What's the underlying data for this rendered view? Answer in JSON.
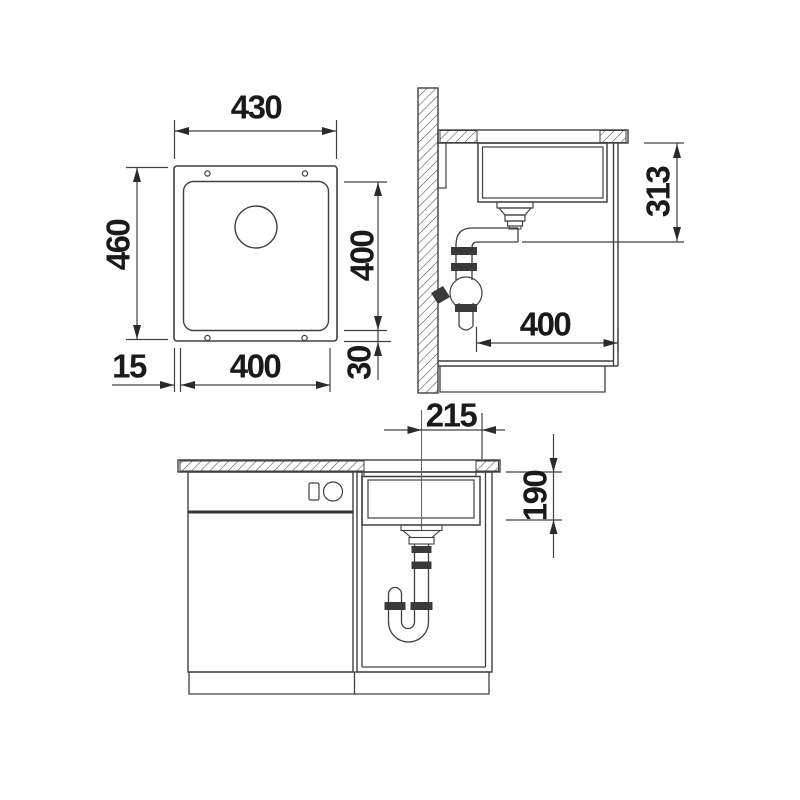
{
  "title": "undermount-sink-installation-drawing",
  "colors": {
    "background": "#ffffff",
    "line": "#404040",
    "dark_fill": "#3a3a3a",
    "text": "#1a1a1a"
  },
  "views": {
    "plan": {
      "name": "top view of sink",
      "dims": {
        "outer_width": "430",
        "outer_depth": "460",
        "bowl_depth_right": "400",
        "bottom_rim": "30",
        "left_rim": "15",
        "bowl_width_bottom": "400"
      }
    },
    "side": {
      "name": "side section view",
      "dims": {
        "install_depth": "313",
        "cabinet_depth": "400"
      }
    },
    "front": {
      "name": "front view in cabinet",
      "dims": {
        "drain_center_offset": "215",
        "bowl_height": "190"
      }
    }
  }
}
